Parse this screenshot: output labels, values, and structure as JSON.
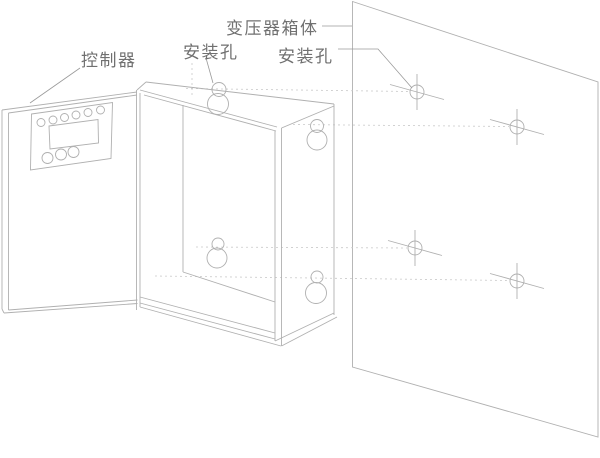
{
  "diagram": {
    "type": "technical-line-drawing",
    "subject": "wall-mounted transformer cabinet installation diagram",
    "labels": {
      "controller": "控制器",
      "box_mounting_hole": "安装孔",
      "wall_mounting_hole": "安装孔",
      "transformer_box": "变压器箱体"
    },
    "counts": {
      "wall_mounting_holes": 4,
      "box_keyhole_slots": 4,
      "controller_small_buttons": 6,
      "controller_large_buttons": 3
    },
    "colors": {
      "line": "#b0b0b0",
      "dashed_line": "#c9c9c9",
      "text": "#707070",
      "background": "#ffffff"
    }
  }
}
